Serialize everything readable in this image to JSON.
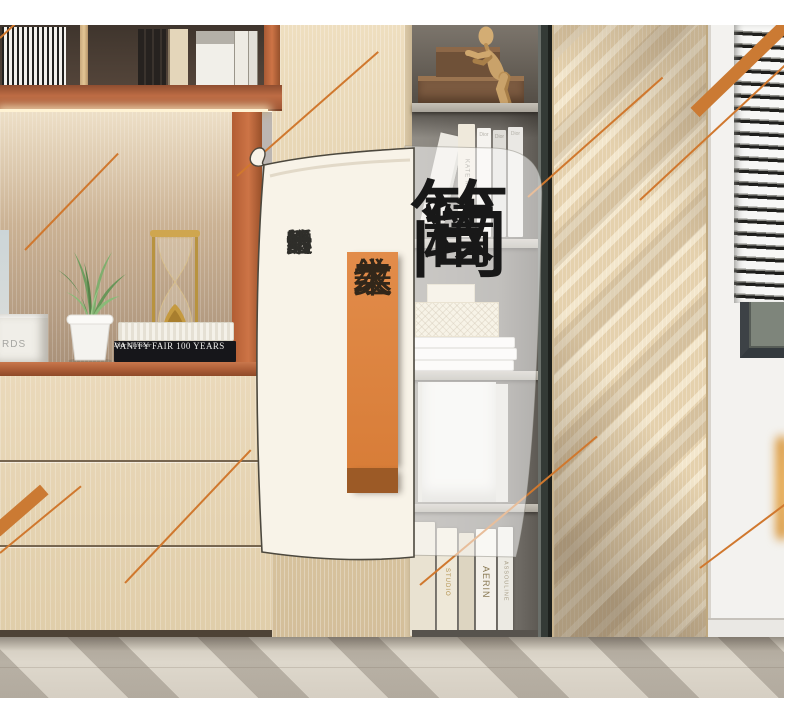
{
  "overlay": {
    "headline": "简。精致",
    "headline_chars": [
      "简",
      "。",
      "精",
      "致"
    ],
    "ribbon": "木纹之美",
    "ribbon_chars": [
      "木",
      "纹",
      "之",
      "美"
    ],
    "slogan": "给心灵一个温暖的场所",
    "slogan_chars": [
      "给",
      "心",
      "灵",
      "一",
      "个",
      "温",
      "暖",
      "的",
      "场",
      "所"
    ]
  },
  "books": {
    "vanity_fair": "VANITY FAIR 100 YEARS",
    "dior_glamour": "Dior Glamour",
    "rds_box": "RDS",
    "kate_moss": "KATE MOSS",
    "dior": "Dior",
    "studio": "STUDIO",
    "aerin": "AERIN",
    "assouline": "ASSOULINE"
  },
  "colors": {
    "accent_orange_line": "#d0782e",
    "ribbon_orange": "#de8440",
    "ribbon_base": "#9c5a26",
    "banner_cream": "#f8f3e8",
    "banner_outline": "#4c483e",
    "headline_ink": "#181818",
    "shelf_terracotta": "#bd6c44"
  }
}
